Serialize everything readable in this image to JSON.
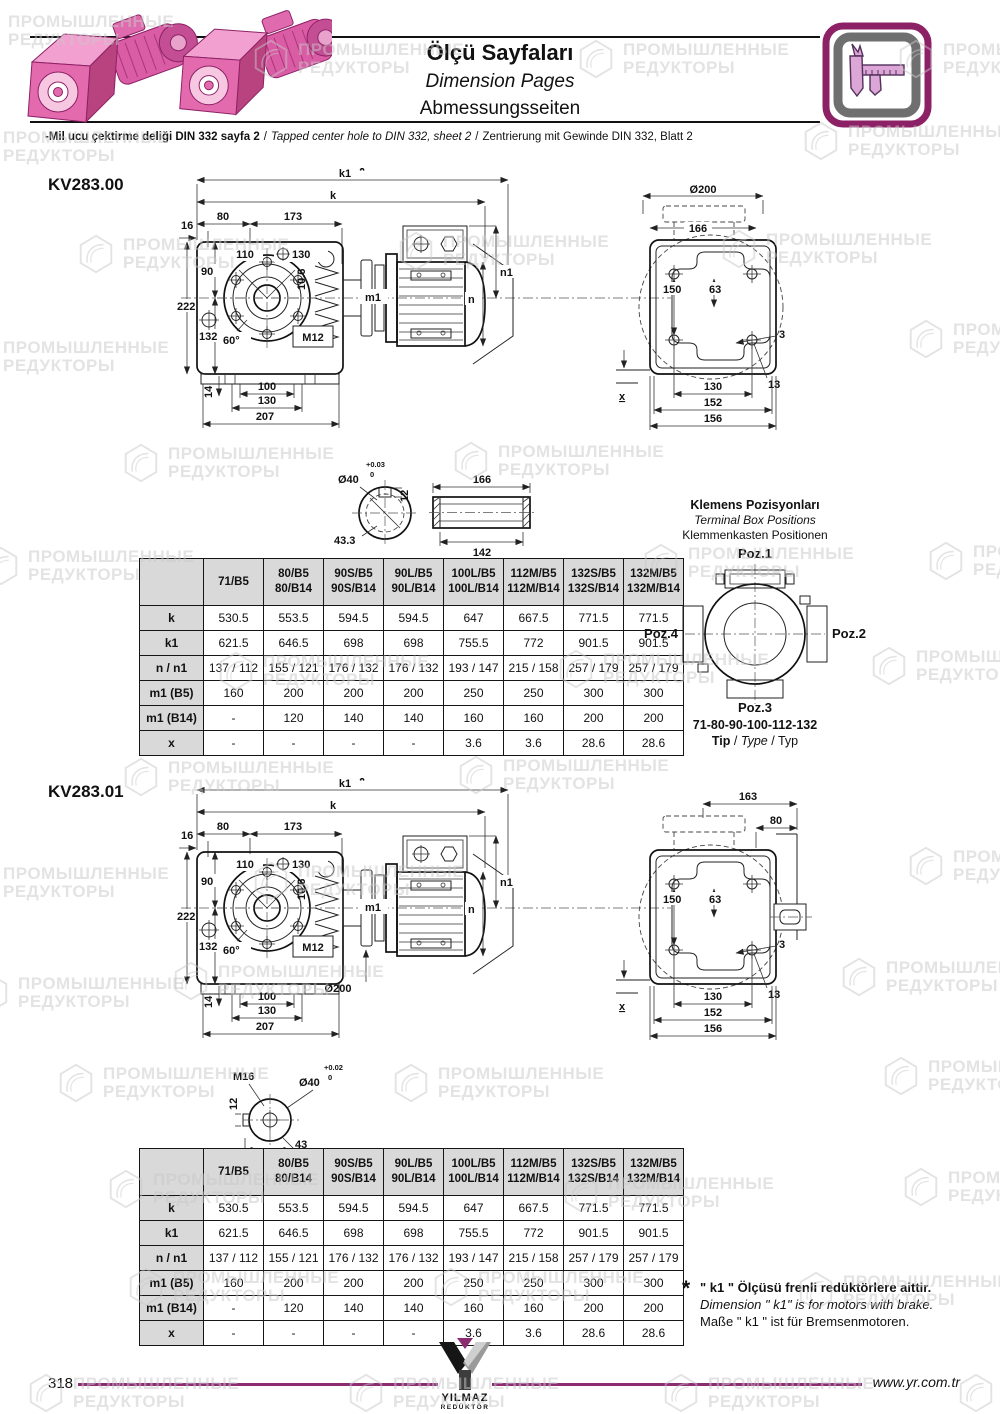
{
  "colors": {
    "accent_purple": "#8c2d74",
    "product_pink": "#e46aae",
    "table_header_bg": "#d9d9d9",
    "watermark_gray": "#c9c9c9"
  },
  "icons": {
    "header_badge": "caliper-icon",
    "footer_logo": "yilmaz-logo",
    "watermark": "hexagon-watermark",
    "header_photos": "pink-gearmotor-photos"
  },
  "watermark": {
    "line1": "ПРОМЫШЛЕННЫЕ",
    "line2": "РЕДУКТОРЫ"
  },
  "header": {
    "title_tr": "Ölçü Sayfaları",
    "title_en": "Dimension Pages",
    "title_de": "Abmessungsseiten",
    "sep": "/",
    "note_tr": "-Mil ucu çektirme deliği DIN 332 sayfa 2",
    "note_en": "Tapped center hole to DIN 332, sheet 2",
    "note_de": "Zentrierung mit Gewinde DIN 332, Blatt 2"
  },
  "terminal_box": {
    "title_tr": "Klemens Pozisyonları",
    "title_en": "Terminal Box Positions",
    "title_de": "Klemmenkasten Positionen",
    "poz1": "Poz.1",
    "poz2": "Poz.2",
    "poz3": "Poz.3",
    "poz4": "Poz.4",
    "sizes": "71-80-90-100-112-132",
    "tip": "Tip",
    "type": "Type",
    "typ": "Typ",
    "sep": "/"
  },
  "footnote": {
    "star": "*",
    "tr": "\" k1 \" Ölçüsü frenli redüktörlere aittir.",
    "en": "Dimension \" k1\" is for motors with brake.",
    "de": "Maße \" k1 \" ist für Bremsenmotoren."
  },
  "footer": {
    "page_number": "318",
    "url": "www.yr.com.tr"
  },
  "logo": {
    "line1": "YILMAZ",
    "line2": "REDÜKTÖR"
  },
  "sections": [
    {
      "code": "KV283.00",
      "side": {
        "star": "*",
        "k1": "k1",
        "k": "k",
        "d80": "80",
        "d173": "173",
        "d16": "16",
        "d110": "110",
        "d130_top": "130",
        "d90": "90",
        "d222": "222",
        "d132": "132",
        "d60": "60°",
        "m12": "M12",
        "d106": "10.6",
        "m1": "m1",
        "n": "n",
        "n1": "n1",
        "d14": "14",
        "d100": "100",
        "d130_bot": "130",
        "d207": "207"
      },
      "rear": {
        "d200": "Ø200",
        "d166": "166",
        "d150": "150",
        "d63": "63",
        "d3": "3",
        "d13": "13",
        "d130": "130",
        "d152": "152",
        "d156": "156",
        "x": "x"
      },
      "shaft": {
        "d40": "Ø40",
        "tol_hi": "+0.03",
        "tol_lo": "0",
        "d12": "12",
        "d433": "43.3",
        "d166": "166",
        "d142": "142"
      },
      "table": {
        "col_headers": [
          [
            "71/B5"
          ],
          [
            "80/B5",
            "80/B14"
          ],
          [
            "90S/B5",
            "90S/B14"
          ],
          [
            "90L/B5",
            "90L/B14"
          ],
          [
            "100L/B5",
            "100L/B14"
          ],
          [
            "112M/B5",
            "112M/B14"
          ],
          [
            "132S/B5",
            "132S/B14"
          ],
          [
            "132M/B5",
            "132M/B14"
          ]
        ],
        "rows": [
          {
            "label": "k",
            "values": [
              "530.5",
              "553.5",
              "594.5",
              "594.5",
              "647",
              "667.5",
              "771.5",
              "771.5"
            ]
          },
          {
            "label": "k1",
            "values": [
              "621.5",
              "646.5",
              "698",
              "698",
              "755.5",
              "772",
              "901.5",
              "901.5"
            ]
          },
          {
            "label": "n / n1",
            "values": [
              "137 / 112",
              "155 / 121",
              "176 / 132",
              "176 / 132",
              "193 / 147",
              "215 / 158",
              "257 / 179",
              "257 / 179"
            ]
          },
          {
            "label": "m1 (B5)",
            "values": [
              "160",
              "200",
              "200",
              "200",
              "250",
              "250",
              "300",
              "300"
            ]
          },
          {
            "label": "m1 (B14)",
            "values": [
              "-",
              "120",
              "140",
              "140",
              "160",
              "160",
              "200",
              "200"
            ]
          },
          {
            "label": "x",
            "values": [
              "-",
              "-",
              "-",
              "-",
              "3.6",
              "3.6",
              "28.6",
              "28.6"
            ]
          }
        ]
      }
    },
    {
      "code": "KV283.01",
      "side": {
        "star": "*",
        "k1": "k1",
        "k": "k",
        "d80": "80",
        "d173": "173",
        "d16": "16",
        "d110": "110",
        "d130_top": "130",
        "d90": "90",
        "d222": "222",
        "d132": "132",
        "d60": "60°",
        "m12": "M12",
        "d106": "10.6",
        "m1": "m1",
        "n": "n",
        "n1": "n1",
        "d14": "14",
        "d100": "100",
        "d130_bot": "130",
        "d207": "207",
        "d200": "Ø200"
      },
      "rear": {
        "d163": "163",
        "d80": "80",
        "d150": "150",
        "d63": "63",
        "d3": "3",
        "d13": "13",
        "d130": "130",
        "d152": "152",
        "d156": "156",
        "x": "x"
      },
      "shaft": {
        "m16": "M16",
        "d40": "Ø40",
        "tol_hi": "+0.02",
        "tol_lo": "0",
        "d12": "12",
        "d43": "43"
      },
      "table": {
        "col_headers": [
          [
            "71/B5"
          ],
          [
            "80/B5",
            "80/B14"
          ],
          [
            "90S/B5",
            "90S/B14"
          ],
          [
            "90L/B5",
            "90L/B14"
          ],
          [
            "100L/B5",
            "100L/B14"
          ],
          [
            "112M/B5",
            "112M/B14"
          ],
          [
            "132S/B5",
            "132S/B14"
          ],
          [
            "132M/B5",
            "132M/B14"
          ]
        ],
        "rows": [
          {
            "label": "k",
            "values": [
              "530.5",
              "553.5",
              "594.5",
              "594.5",
              "647",
              "667.5",
              "771.5",
              "771.5"
            ]
          },
          {
            "label": "k1",
            "values": [
              "621.5",
              "646.5",
              "698",
              "698",
              "755.5",
              "772",
              "901.5",
              "901.5"
            ]
          },
          {
            "label": "n / n1",
            "values": [
              "137 / 112",
              "155 / 121",
              "176 / 132",
              "176 / 132",
              "193 / 147",
              "215 / 158",
              "257 / 179",
              "257 / 179"
            ]
          },
          {
            "label": "m1 (B5)",
            "values": [
              "160",
              "200",
              "200",
              "200",
              "250",
              "250",
              "300",
              "300"
            ]
          },
          {
            "label": "m1 (B14)",
            "values": [
              "-",
              "120",
              "140",
              "140",
              "160",
              "160",
              "200",
              "200"
            ]
          },
          {
            "label": "x",
            "values": [
              "-",
              "-",
              "-",
              "-",
              "3.6",
              "3.6",
              "28.6",
              "28.6"
            ]
          }
        ]
      }
    }
  ]
}
